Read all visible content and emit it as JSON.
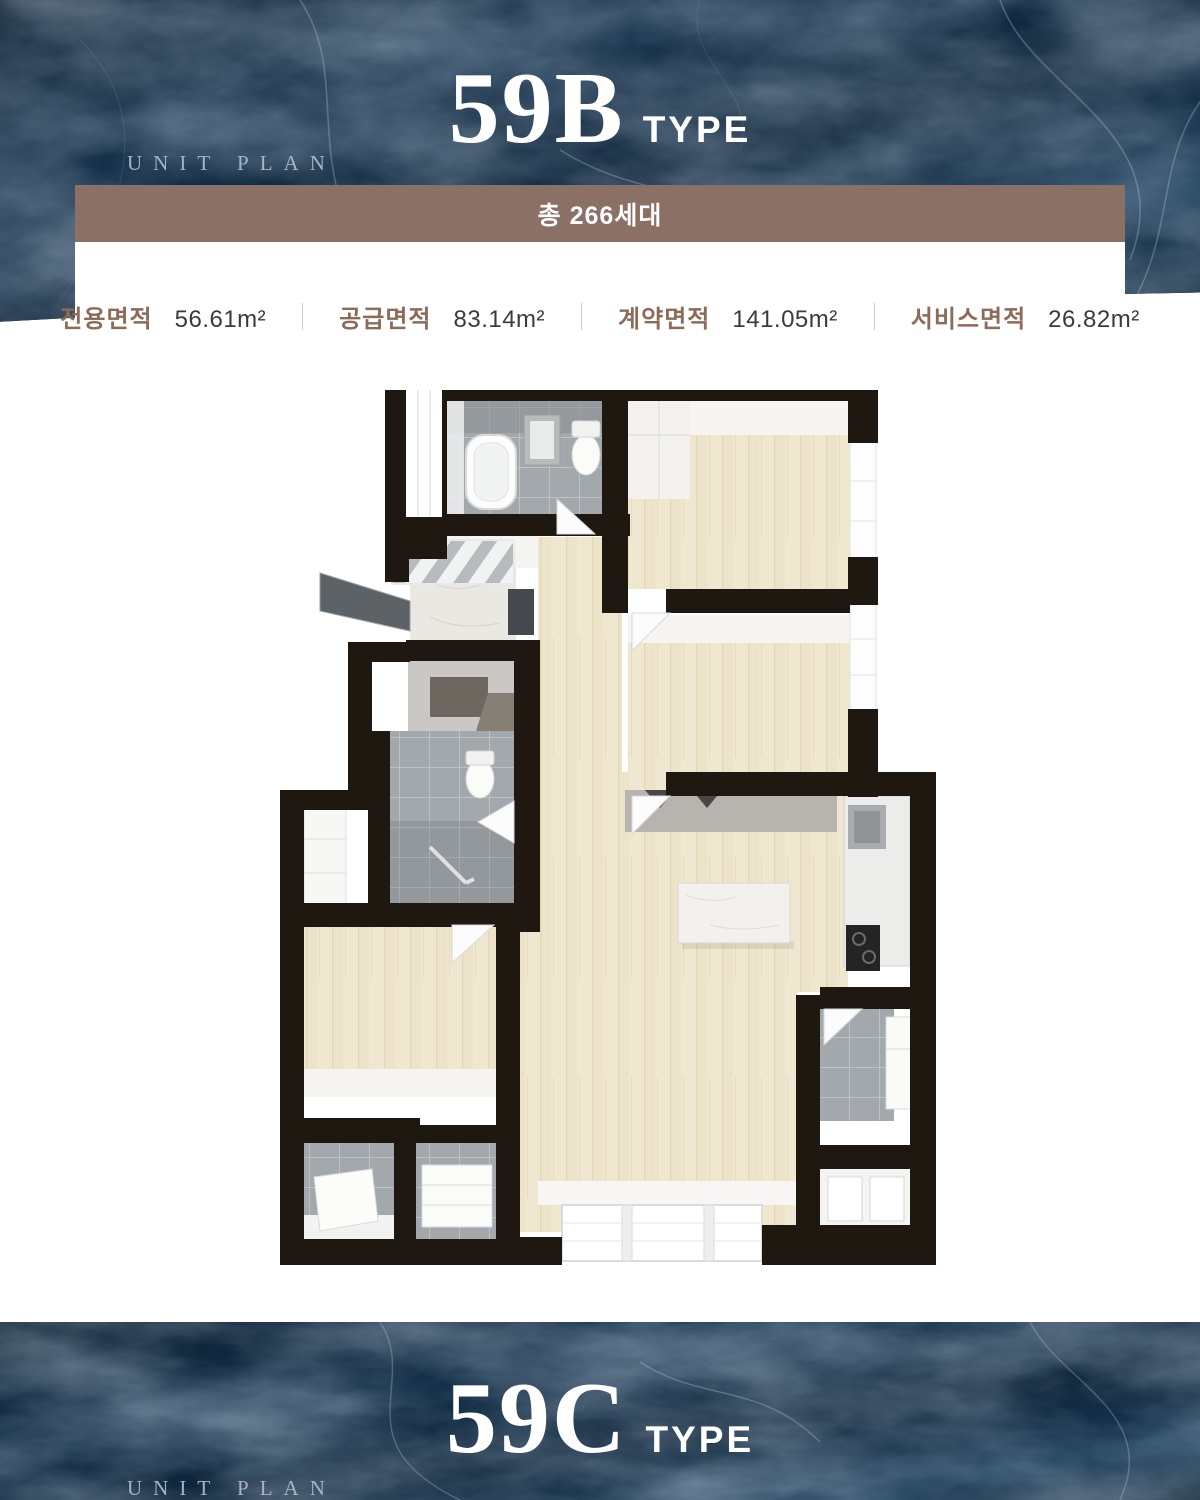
{
  "top_banner": {
    "eyebrow": "UNIT PLAN",
    "title": "59B",
    "title_suffix": "TYPE"
  },
  "summary": {
    "total_units": "총 266세대",
    "stats": [
      {
        "label": "전용면적",
        "value": "56.61m²"
      },
      {
        "label": "공급면적",
        "value": "83.14m²"
      },
      {
        "label": "계약면적",
        "value": "141.05m²"
      },
      {
        "label": "서비스면적",
        "value": "26.82m²"
      }
    ]
  },
  "floor_plan": {
    "description": "59B type 3D floor plan"
  },
  "bottom_banner": {
    "eyebrow": "UNIT PLAN",
    "title": "59C",
    "title_suffix": "TYPE"
  },
  "colors": {
    "navy": "#0e2335",
    "brown_bar": "#8b7065",
    "label_brown": "#8d6b59",
    "value_gray": "#3b3b3b",
    "eyebrow_gray": "#aab3bc",
    "wall_black": "#1f1811",
    "wood": "#f0e7d1",
    "tile_gray": "#a3a8ac"
  }
}
